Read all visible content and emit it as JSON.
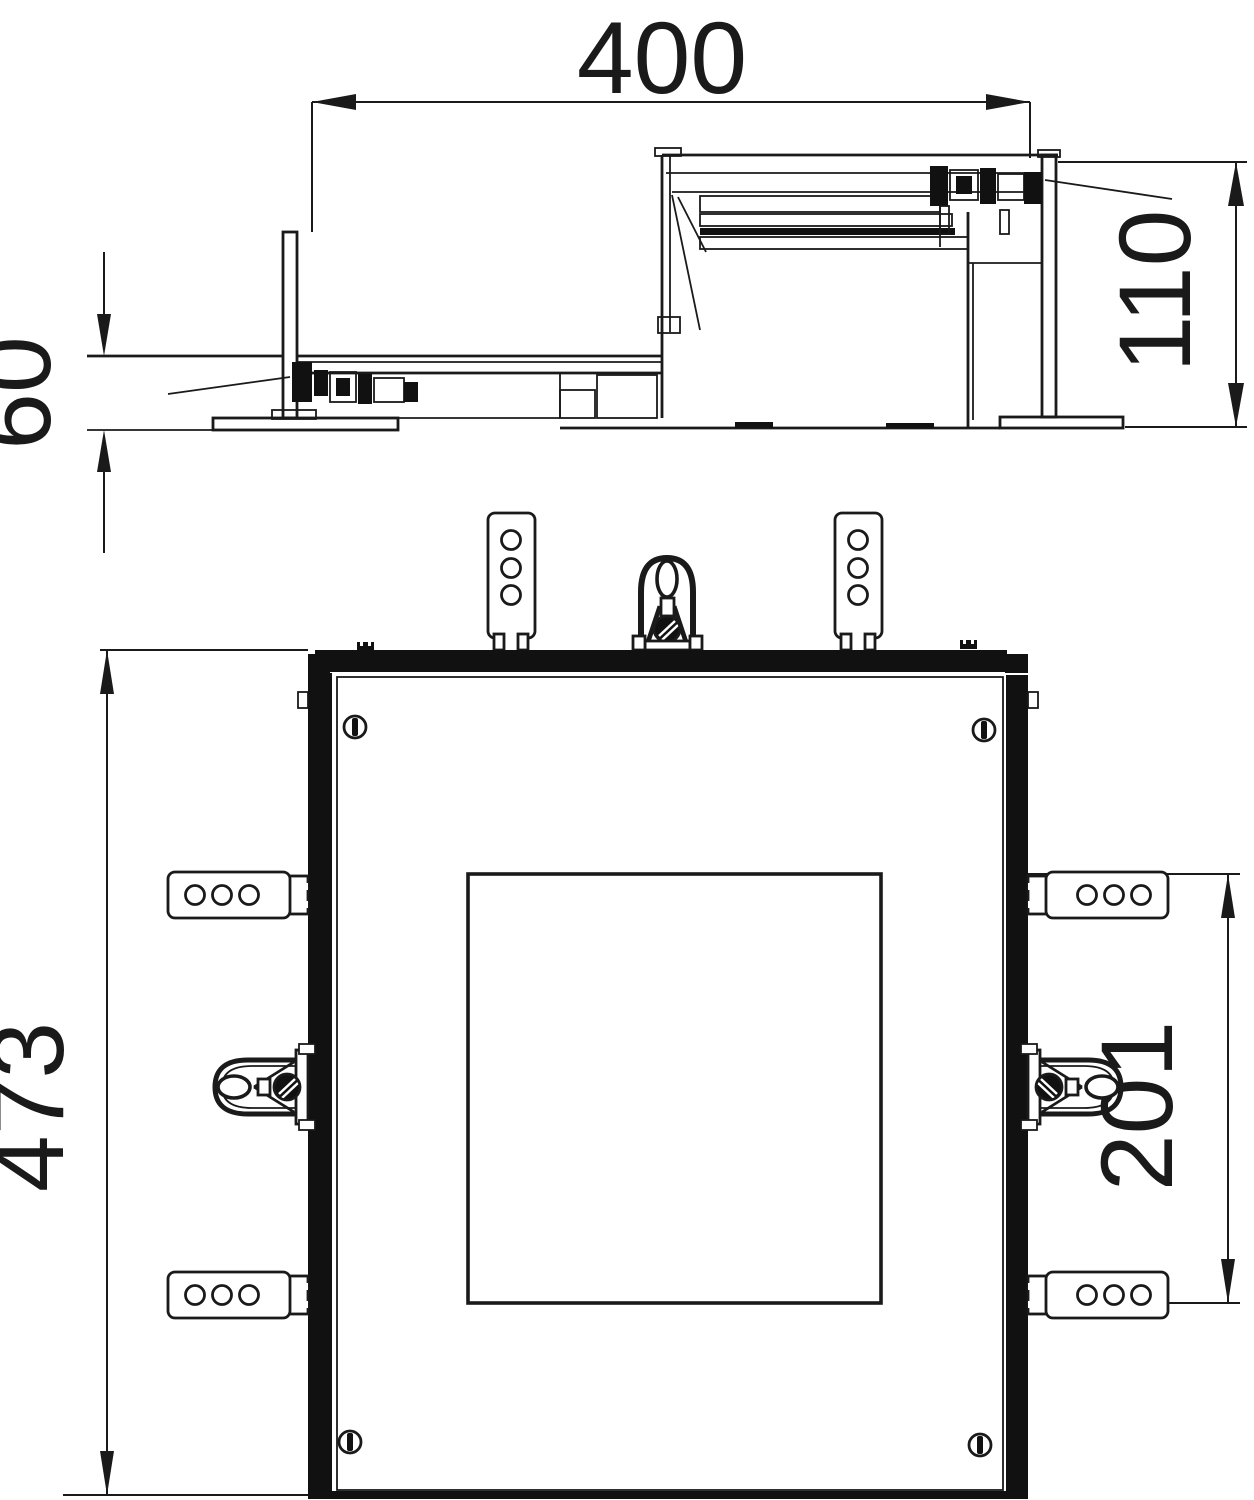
{
  "title": "Technical dimension drawing - floor box mounting unit, side elevation and plan view",
  "dims": {
    "d400": "400",
    "d110": "110",
    "d60": "60",
    "d473": "473",
    "d201": "201"
  },
  "views": {
    "side_view": "side elevation with height-adjustable unit (min 60, max 110, width 400)",
    "plan_view": "top plan view (overall 473, inner cutout 201)"
  },
  "components": {
    "plan": [
      "top-mounting-bracket x2 (3 holes)",
      "side-mounting-bracket x4 (3 holes)",
      "lifting-handle top x1",
      "side-handle x2",
      "slotted-screw x4",
      "frame-bars (top/left/right/bottom)",
      "inner-cutout-square"
    ],
    "side": [
      "low-section left (60 mm)",
      "raised-section right (110 mm)",
      "clamp-mechanism x2 with leader lines",
      "support posts",
      "base plates"
    ]
  },
  "colors": {
    "line": "#1a1a1a",
    "fill": "#111111",
    "background": "#ffffff"
  }
}
